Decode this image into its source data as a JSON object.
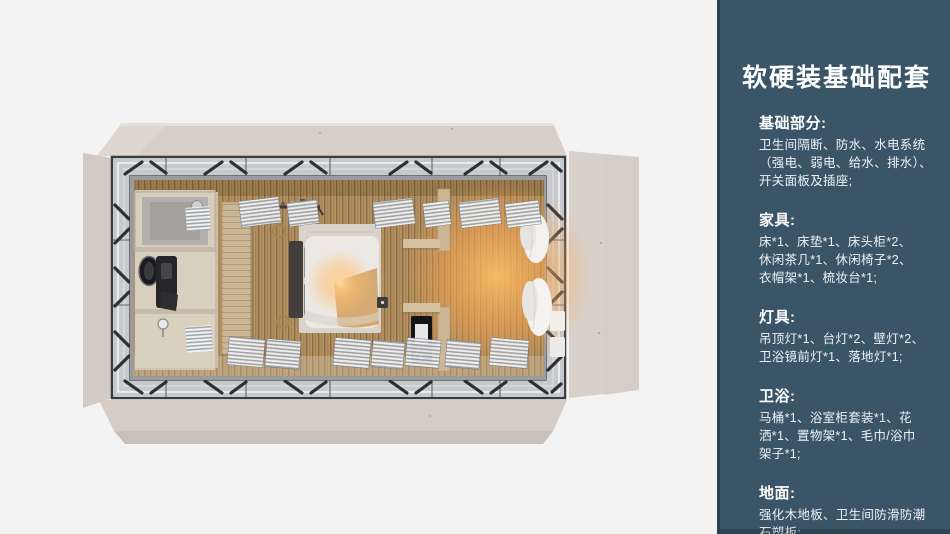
{
  "slide": {
    "background_color": "#f3f3f4"
  },
  "sidebar": {
    "background_color": "#3a5568",
    "edge_color": "#2c4254",
    "text_color": "#ffffff",
    "title": "软硬装基础配套",
    "sections": [
      {
        "title": "基础部分:",
        "lines": [
          "卫生间隔断、防水、水电系统",
          "（强电、弱电、给水、排水）、",
          "开关面板及插座;"
        ]
      },
      {
        "title": "家具:",
        "lines": [
          "床*1、床垫*1、床头柜*2、",
          "休闲茶几*1、休闲椅子*2、",
          "衣帽架*1、梳妆台*1;"
        ]
      },
      {
        "title": "灯具:",
        "lines": [
          "吊顶灯*1、台灯*2、壁灯*2、",
          "卫浴镜前灯*1、落地灯*1;"
        ]
      },
      {
        "title": "卫浴:",
        "lines": [
          "马桶*1、浴室柜套装*1、花",
          "洒*1、置物架*1、毛巾/浴巾",
          "架子*1;"
        ]
      },
      {
        "title": "地面:",
        "lines": [
          "强化木地板、卫生间防滑防潮",
          "石塑板;"
        ]
      }
    ]
  },
  "floorplan": {
    "description": "top-down 3D render of a prefab cabin: bathroom at left, bedroom with double bed in the middle, warm-lit lounge with curtains at right, fold-out beige panels around a dark steel frame",
    "areas": [
      "bathroom",
      "wardrobe",
      "bedroom",
      "shelving",
      "lounge"
    ],
    "palette": {
      "flap_beige": "#d7cfc7",
      "frame_dark": "#383d44",
      "walkway_gray": "#c8c9cb",
      "wood_floor": "#b2905f",
      "warm_glow": "#ffb85e",
      "bathroom_beige": "#d6cdbd",
      "bed_duvet_white": "#ece9e4",
      "curtain_white": "#f2f1ef"
    }
  }
}
